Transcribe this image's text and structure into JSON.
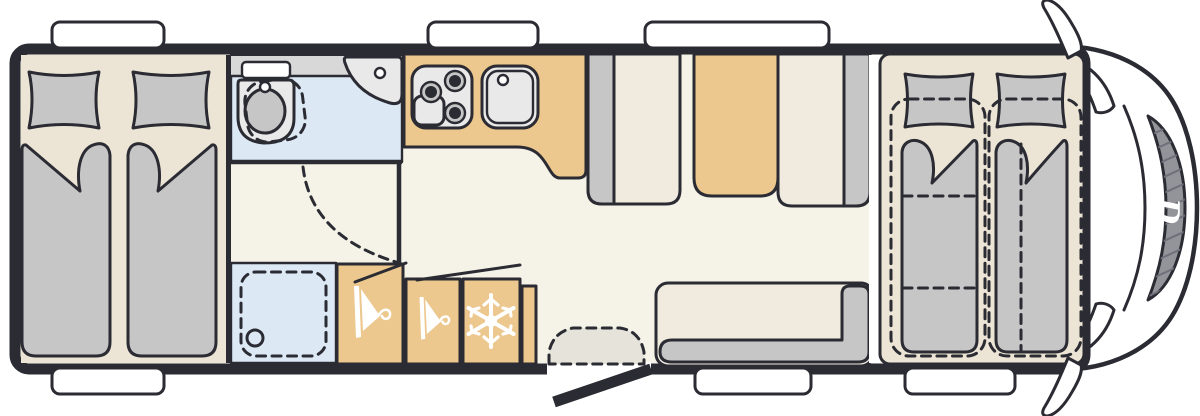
{
  "logo": {
    "text": "D"
  },
  "palette": {
    "wall": "#2B2B33",
    "floor": "#F5F3E7",
    "bedfloor": "#ECE5D6",
    "tan": "#ECC78E",
    "blue": "#DCE9F5",
    "gray": "#C6C6C6",
    "cream": "#F0EBDE",
    "app": "#E9E9E9",
    "counter": "#D8D8D8",
    "step": "#E6E3DB",
    "windshield": "#93939A"
  },
  "floorplan": {
    "type": "motorhome-top-view-floorplan",
    "logo_text": "D",
    "areas": {
      "rear_bedroom": {
        "single_beds": 2,
        "pillows": 2
      },
      "washroom": {
        "fixtures": [
          "swivel-toilet",
          "corner-basin",
          "vanity-counter"
        ]
      },
      "shower": {
        "fixtures": [
          "shower-tray",
          "drain"
        ]
      },
      "kitchen": {
        "fixtures": [
          "hob-3-burner",
          "sink",
          "worktop"
        ]
      },
      "dinette": {
        "bench_seats": 2,
        "table": 1
      },
      "side_bench": {
        "seats": 1
      },
      "wardrobes": 2,
      "fridge": 1,
      "entry": {
        "items": [
          "entry-step",
          "open-door"
        ]
      },
      "front_sleeping": {
        "single_beds": 2,
        "drop_down_bed_dashed": true
      },
      "cab": {
        "items": [
          "windshield",
          "side-mirror-left",
          "side-mirror-right",
          "brand-logo"
        ]
      }
    },
    "windows": {
      "top_wall": 3,
      "bottom_wall": 3
    },
    "icons": [
      "hanger-icon",
      "hanger-icon",
      "snowflake-icon"
    ]
  }
}
